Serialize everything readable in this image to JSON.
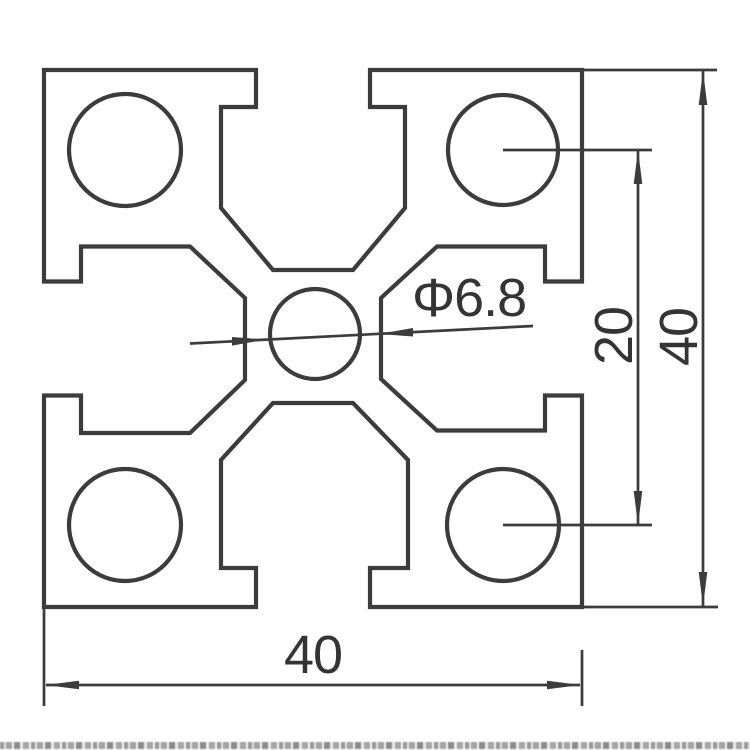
{
  "drawing": {
    "line_color": "#3c3c3c",
    "text_color": "#343434",
    "background": "#ffffff",
    "labels": {
      "overall_width": "40",
      "overall_height": "40",
      "hole_spacing": "20",
      "center_hole_diameter": "Φ6.8"
    }
  }
}
